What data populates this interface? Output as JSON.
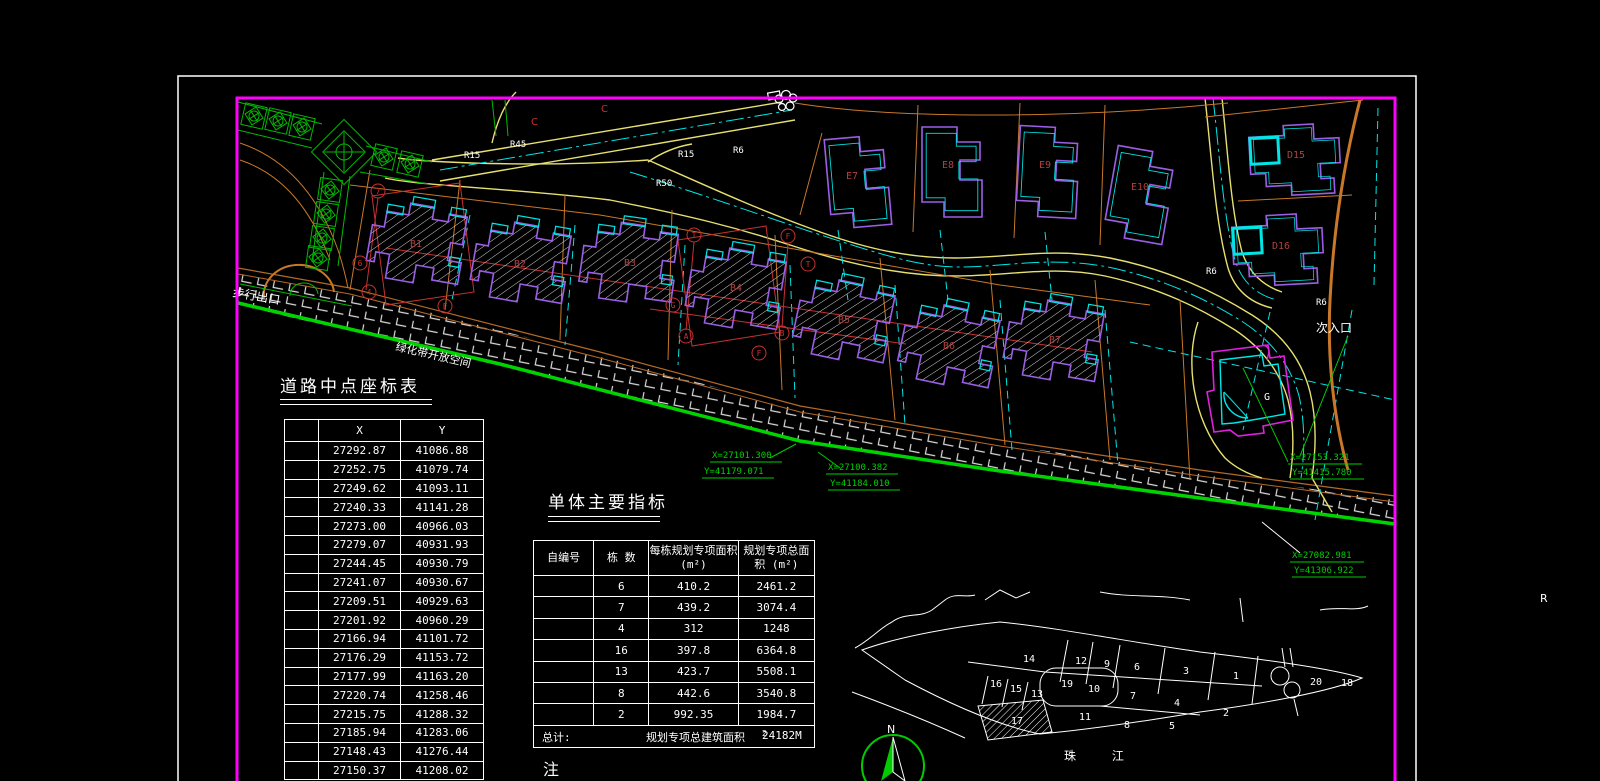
{
  "drawing": {
    "coord_table": {
      "title": "道路中点座标表",
      "headers": [
        "",
        "X",
        "Y"
      ],
      "rows": [
        [
          "27292.87",
          "41086.88"
        ],
        [
          "27252.75",
          "41079.74"
        ],
        [
          "27249.62",
          "41093.11"
        ],
        [
          "27240.33",
          "41141.28"
        ],
        [
          "27273.00",
          "40966.03"
        ],
        [
          "27279.07",
          "40931.93"
        ],
        [
          "27244.45",
          "40930.79"
        ],
        [
          "27241.07",
          "40930.67"
        ],
        [
          "27209.51",
          "40929.63"
        ],
        [
          "27201.92",
          "40960.29"
        ],
        [
          "27166.94",
          "41101.72"
        ],
        [
          "27176.29",
          "41153.72"
        ],
        [
          "27177.99",
          "41163.20"
        ],
        [
          "27220.74",
          "41258.46"
        ],
        [
          "27215.75",
          "41288.32"
        ],
        [
          "27185.94",
          "41283.06"
        ],
        [
          "27148.43",
          "41276.44"
        ],
        [
          "27150.37",
          "41208.02"
        ]
      ]
    },
    "indicator_table": {
      "title": "单体主要指标",
      "headers": [
        "自编号",
        "栋 数",
        "每栋规划专项面积 (m²)",
        "规划专项总面积 (m²)"
      ],
      "rows": [
        [
          "",
          "6",
          "410.2",
          "2461.2"
        ],
        [
          "",
          "7",
          "439.2",
          "3074.4"
        ],
        [
          "",
          "4",
          "312",
          "1248"
        ],
        [
          "",
          "16",
          "397.8",
          "6364.8"
        ],
        [
          "",
          "13",
          "423.7",
          "5508.1"
        ],
        [
          "",
          "8",
          "442.6",
          "3540.8"
        ],
        [
          "",
          "2",
          "992.35",
          "1984.7"
        ]
      ],
      "footer": {
        "label": "总计:",
        "desc": "规划专项总建筑面积",
        "value": "24182M",
        "value_sup": "2"
      }
    },
    "note_label": "注",
    "plan": {
      "building_labels": [
        "B1",
        "B2",
        "B3",
        "B4",
        "B5",
        "B6",
        "B7",
        "E7",
        "E8",
        "E9",
        "E10",
        "D15",
        "D16",
        "G"
      ],
      "road_labels": [
        "R45",
        "R15",
        "R50",
        "R6",
        "R15",
        "R6",
        "R6"
      ],
      "area_labels": {
        "pedestrian_exit": "步行出口",
        "secondary_entrance": "次入口",
        "green_belt": "绿化带开放空间",
        "c_mark": "C"
      },
      "coord_notes": [
        {
          "x": "X=27101.300",
          "y": "Y=41179.071"
        },
        {
          "x": "X=27100.382",
          "y": "Y=41184.010"
        },
        {
          "x": "X=27153.321",
          "y": "Y=41415.780"
        },
        {
          "x": "X=27082.981",
          "y": "Y=41306.922"
        }
      ],
      "grid_bubbles": [
        "7",
        "6",
        "4",
        "F",
        "T",
        "F",
        "G",
        "A",
        "T",
        "B",
        "F"
      ],
      "stray_r": "R"
    },
    "keymap": {
      "parcels": [
        "14",
        "12",
        "9",
        "6",
        "3",
        "1",
        "20",
        "18",
        "16",
        "15",
        "13",
        "19",
        "10",
        "7",
        "4",
        "2",
        "17",
        "11",
        "8",
        "5"
      ],
      "hatched_parcel": "17",
      "river": "珠 江",
      "north": "N"
    },
    "colors": {
      "border": "#ff00ff",
      "frame": "#ffffff",
      "road": "#e6e070",
      "shore": "#00d400",
      "parcel": "#c87828",
      "grid": "#c83030",
      "building_outline": "#9b5fe6",
      "accent": "#00e6e6",
      "landscape": "#00bb00"
    }
  }
}
